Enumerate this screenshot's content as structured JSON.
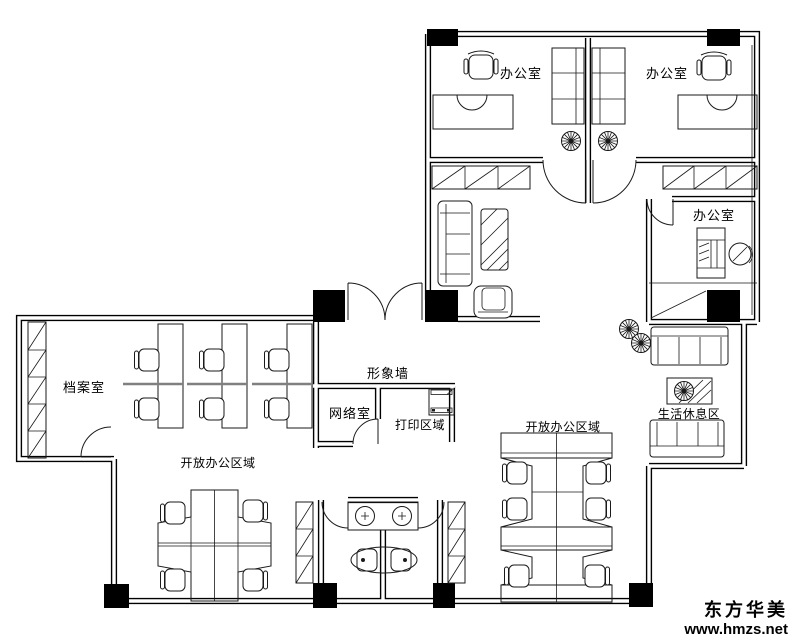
{
  "canvas": {
    "width": 800,
    "height": 640,
    "background": "#ffffff",
    "line_color": "#000000"
  },
  "labels": {
    "office_top_left": "办公室",
    "office_top_right": "办公室",
    "office_right": "办公室",
    "archive_room": "档案室",
    "feature_wall": "形象墙",
    "network_room": "网络室",
    "print_area": "打印区域",
    "open_office_left": "开放办公区域",
    "open_office_right": "开放办公区域",
    "rest_area": "生活休息区"
  },
  "watermark": {
    "brand": "东方华美",
    "website": "www.hmzs.net"
  }
}
